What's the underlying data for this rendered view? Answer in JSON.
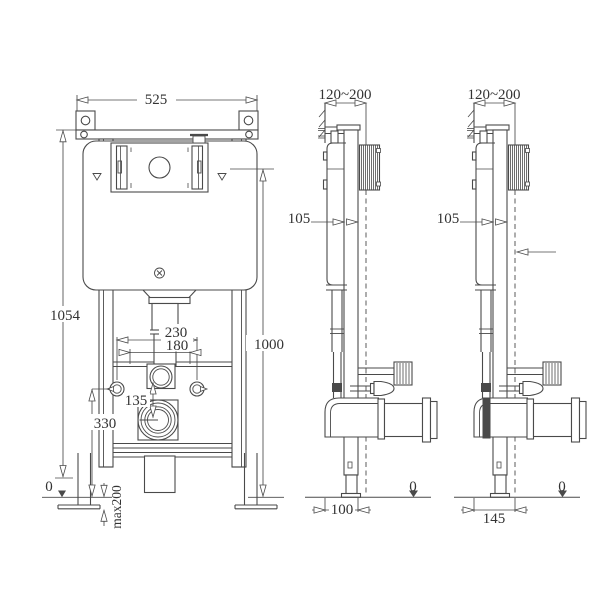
{
  "drawing": {
    "background": "#ffffff",
    "line_color": "#4a4a4a",
    "text_color": "#333333",
    "front_view": {
      "width": "525",
      "frame_height": "1054",
      "flush_plate_height": "1000",
      "bolt_spacing_outer": "230",
      "bolt_spacing_inner": "180",
      "inlet_to_outlet_offset": "135",
      "outlet_height": "330",
      "foot_adjustment": "max200",
      "floor_level": "0"
    },
    "side_view_min": {
      "installation_depth": "120~200",
      "profile_depth": "105",
      "outlet_distance": "100",
      "floor_level": "0"
    },
    "side_view_max": {
      "installation_depth": "120~200",
      "profile_depth": "105",
      "outlet_distance": "145",
      "floor_level": "0"
    }
  }
}
